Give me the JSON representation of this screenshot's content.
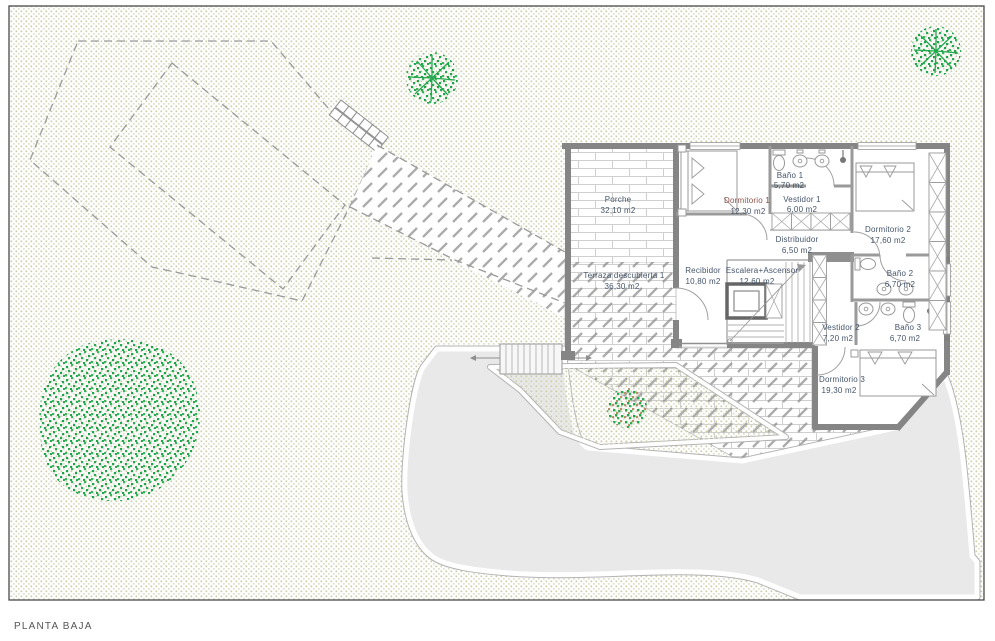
{
  "title": "PLANTA BAJA",
  "rooms": [
    {
      "id": "porche",
      "name": "Porche",
      "area": "32,10 m2"
    },
    {
      "id": "terraza",
      "name": "Terraza descubierta 1",
      "area": "36,30 m2"
    },
    {
      "id": "dormitorio-1",
      "name": "Dormitorio 1",
      "area": "12,30 m2"
    },
    {
      "id": "bano-1",
      "name": "Baño 1",
      "area": "5,70 m2"
    },
    {
      "id": "vestidor-1",
      "name": "Vestidor 1",
      "area": "6,00 m2"
    },
    {
      "id": "distribuidor",
      "name": "Distribuidor",
      "area": "6,50 m2"
    },
    {
      "id": "dormitorio-2",
      "name": "Dormitorio 2",
      "area": "17,60 m2"
    },
    {
      "id": "recibidor",
      "name": "Recibidor",
      "area": "10,80 m2"
    },
    {
      "id": "escalera",
      "name": "Escalera+Ascensor",
      "area": "12,60 m2"
    },
    {
      "id": "bano-2",
      "name": "Baño 2",
      "area": "6,70 m2"
    },
    {
      "id": "vestidor-2",
      "name": "Vestidor 2",
      "area": "7,20 m2"
    },
    {
      "id": "bano-3",
      "name": "Baño 3",
      "area": "6,70 m2"
    },
    {
      "id": "dormitorio-3",
      "name": "Dormitorio 3",
      "area": "19,30 m2"
    }
  ],
  "colors": {
    "foliage_green": "#22a84c",
    "label_blue": "#44546a",
    "label_accent": "#8a5048",
    "wall_gray": "#858585",
    "driveway_gray": "#e9e9e9",
    "grass_stipple": "#ccccaa",
    "hatch_gray": "#8f8f8f",
    "brick_joint": "#cfcfcf"
  }
}
